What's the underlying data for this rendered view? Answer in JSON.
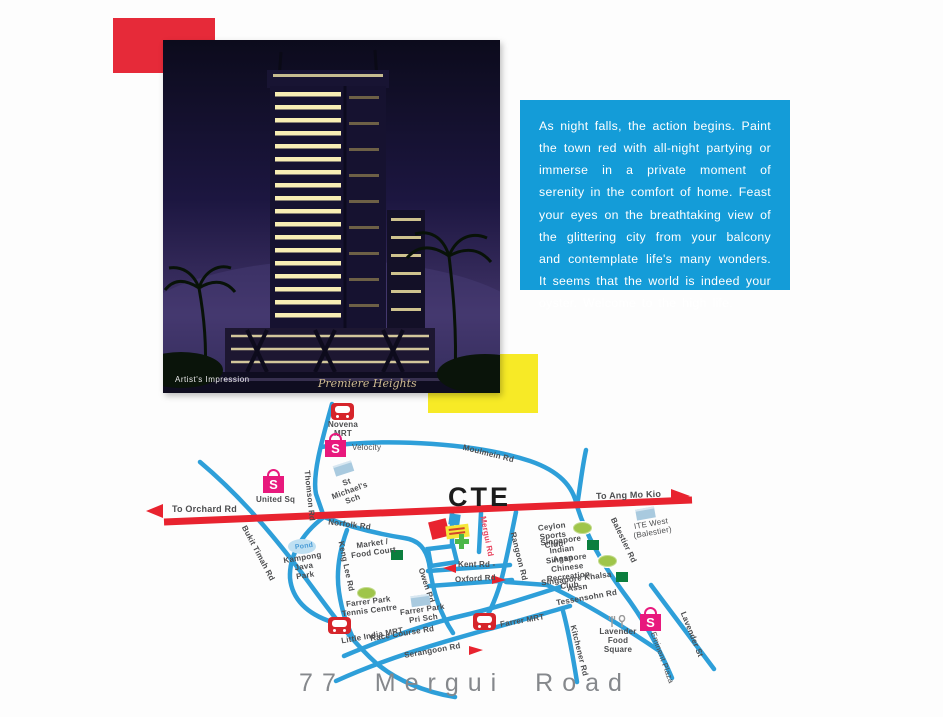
{
  "photo": {
    "caption": "Artist's Impression",
    "script": "Premiere Heights"
  },
  "intro": {
    "text": "As night falls, the action begins. Paint the town red with all-night partying or immerse in a private moment of serenity in the comfort of home. Feast your eyes on the breathtaking view of the glittering city from your balcony and contemplate life's many wonders. It seems that the world is indeed your oyster. Welcome to the high life."
  },
  "footer": {
    "address": "77 Mergui Road"
  },
  "colors": {
    "accent_red": "#E62A39",
    "accent_yellow": "#F7EA26",
    "accent_blue": "#149CD8",
    "road_blue": "#2E9FD9",
    "expressway_red": "#E8232F",
    "mall_pink": "#E8197D",
    "mrt_red": "#D6252B",
    "club_green": "#0B7E3E",
    "field_green": "#9FC54A",
    "school_blue": "#A9CADF"
  },
  "map": {
    "expressway": {
      "name": "CTE",
      "to_left": "To Orchard Rd",
      "to_right": "To Ang Mo Kio"
    },
    "roads": {
      "thomson": "Thomson Rd",
      "moulmein": "Moulmein Rd",
      "norfolk": "Norfolk Rd",
      "keng_lee": "Keng Lee Rd",
      "bukit_timah": "Bukit Timah Rd",
      "owen": "Owen Rd",
      "mergui": "Mergui Rd",
      "rangoon": "Rangoon Rd",
      "kent": "Kent Rd -",
      "oxford": "Oxford Rd",
      "race_course": "Race Course Rd",
      "serangoon": "Serangoon Rd",
      "tessensohn": "Tessensohn Rd",
      "kitchener": "Kitchener Rd",
      "balestier": "Balestier Rd",
      "lavender": "Lavender St"
    },
    "stations": {
      "novena": "Novena\nMRT",
      "little_india": "Little India MRT",
      "farrer": "Farrer MRT"
    },
    "malls": {
      "bag_letter": "S",
      "velocity": "Velocity",
      "united_sq": "United Sq",
      "lavender_food": "Lavender\nFood\nSquare",
      "eminent": "Eminent Plaza"
    },
    "schools": {
      "st_michaels": "St Michael's\nSch",
      "farrer_park_pri": "Farrer Park\nPri Sch",
      "ite_west": "ITE West\n(Balestier)"
    },
    "clubs": {
      "ceylon": "Ceylon\nSports Club",
      "indian": "Singapore\nIndian\nAssn",
      "chinese_rec": "Singapore\nChinese\nRecreation\nClub",
      "khalsa": "Singapore Khalsa\nAssn",
      "tennis": "Farrer Park\nTennis Centre",
      "market": "Market /\nFood Court"
    },
    "areas": {
      "pond": "Pond",
      "kampong": "Kampong\nJava\nPark"
    }
  }
}
